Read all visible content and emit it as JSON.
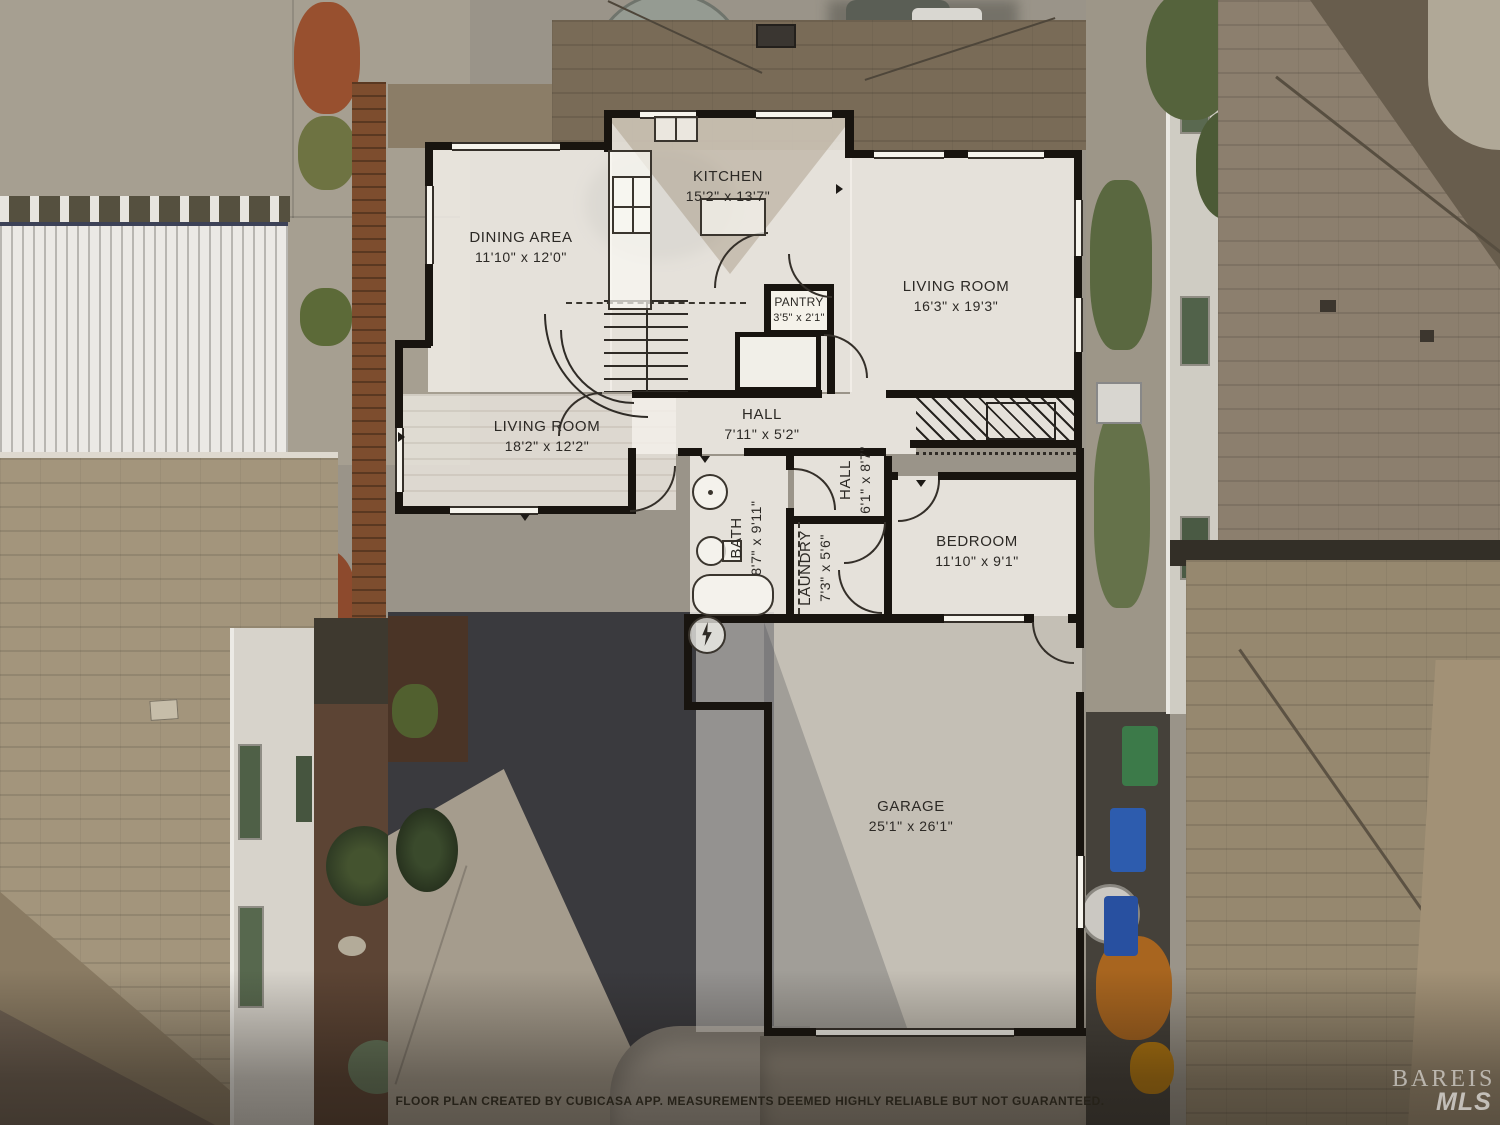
{
  "palette": {
    "wall": "#18140f",
    "room_fill": "rgba(243,240,233,0.84)",
    "label_color": "#2c2925",
    "watermark_color": "rgba(255,255,255,0.6)"
  },
  "floor_plan": {
    "rooms": [
      {
        "name": "kitchen",
        "label": "KITCHEN",
        "dims": "15'2\" x 13'7\""
      },
      {
        "name": "dining-area",
        "label": "DINING AREA",
        "dims": "11'10\" x 12'0\""
      },
      {
        "name": "living-room-main",
        "label": "LIVING ROOM",
        "dims": "16'3\" x 19'3\""
      },
      {
        "name": "pantry",
        "label": "PANTRY",
        "dims": "3'5\" x 2'1\""
      },
      {
        "name": "living-room-second",
        "label": "LIVING ROOM",
        "dims": "18'2\" x 12'2\""
      },
      {
        "name": "hall",
        "label": "HALL",
        "dims": "7'11\" x 5'2\""
      },
      {
        "name": "hall-vertical",
        "label": "HALL",
        "dims": "6'1\" x 8'7\""
      },
      {
        "name": "bath",
        "label": "BATH",
        "dims": "8'7\" x 9'11\""
      },
      {
        "name": "laundry",
        "label": "LAUNDRY",
        "dims": "7'3\" x 5'6\""
      },
      {
        "name": "bedroom",
        "label": "BEDROOM",
        "dims": "11'10\" x 9'1\""
      },
      {
        "name": "garage",
        "label": "GARAGE",
        "dims": "25'1\" x 26'1\""
      }
    ],
    "footer": {
      "disclaimer": "FLOOR PLAN CREATED BY CUBICASA APP. MEASUREMENTS DEEMED HIGHLY RELIABLE BUT NOT GUARANTEED."
    },
    "watermark": {
      "line1": "BAREIS",
      "line2": "MLS"
    }
  }
}
